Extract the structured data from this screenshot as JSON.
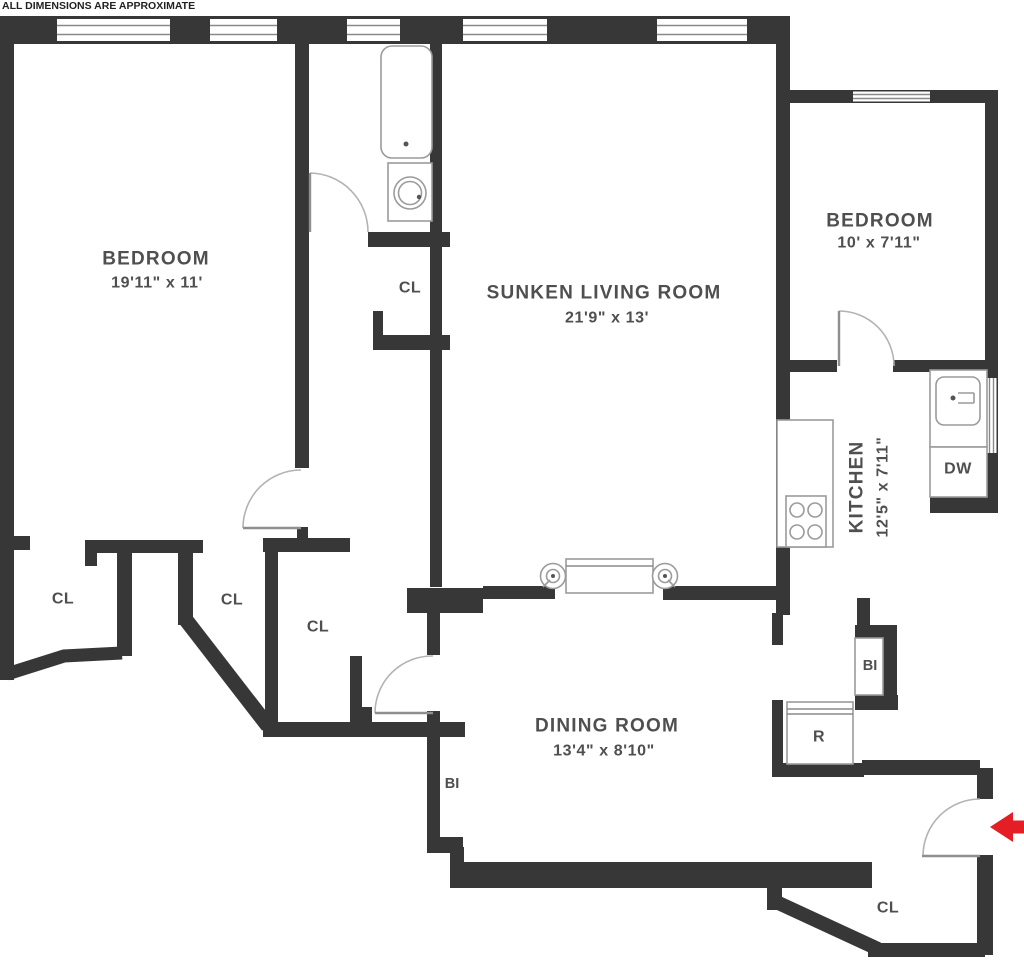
{
  "disclaimer": "ALL DIMENSIONS ARE APPROXIMATE",
  "rooms": {
    "bedroom_left": {
      "name": "BEDROOM",
      "dims": "19'11\" x 11'"
    },
    "living_room": {
      "name": "SUNKEN LIVING ROOM",
      "dims": "21'9\" x 13'"
    },
    "bedroom_right": {
      "name": "BEDROOM",
      "dims": "10' x 7'11\""
    },
    "kitchen": {
      "name": "KITCHEN",
      "dims": "12'5\" x 7'11\""
    },
    "dining_room": {
      "name": "DINING ROOM",
      "dims": "13'4\" x 8'10\""
    }
  },
  "labels": {
    "closet": "CL",
    "dishwasher": "DW",
    "built_in": "BI",
    "refrigerator": "R"
  },
  "colors": {
    "wall": "#373737",
    "fixture_outline": "#9b9b9b",
    "label_text": "#4f4f4f",
    "entry_arrow": "#e31e24"
  }
}
